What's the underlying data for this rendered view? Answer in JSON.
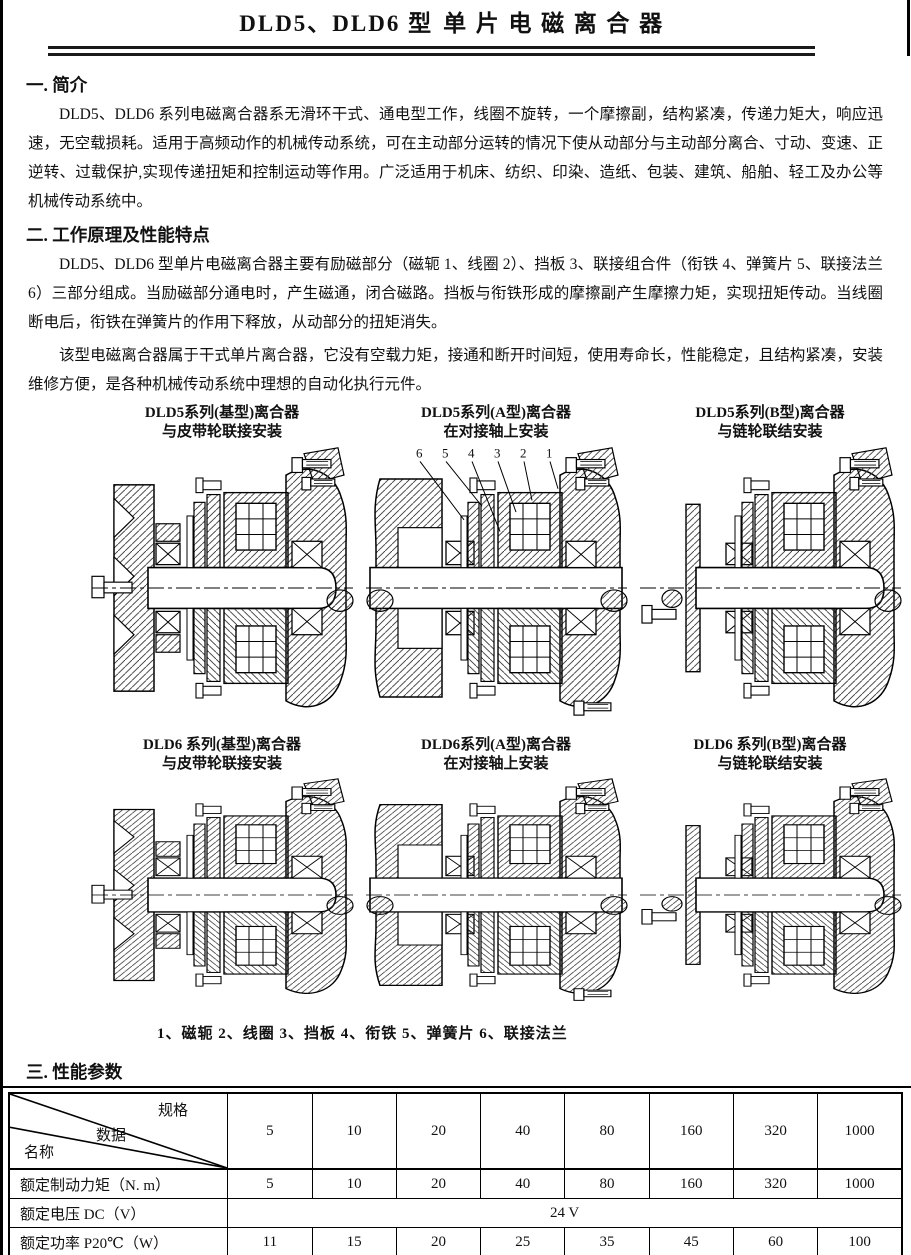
{
  "page": {
    "title_model": "DLD5、DLD6 型",
    "title_name": "单片电磁离合器"
  },
  "sections": {
    "s1": {
      "heading": "一. 简介",
      "p1": "DLD5、DLD6 系列电磁离合器系无滑环干式、通电型工作，线圈不旋转，一个摩擦副，结构紧凑，传递力矩大，响应迅速，无空载损耗。适用于高频动作的机械传动系统，可在主动部分运转的情况下使从动部分与主动部分离合、寸动、变速、正逆转、过载保护,实现传递扭矩和控制运动等作用。广泛适用于机床、纺织、印染、造纸、包装、建筑、船舶、轻工及办公等机械传动系统中。"
    },
    "s2": {
      "heading": "二. 工作原理及性能特点",
      "p1": "DLD5、DLD6 型单片电磁离合器主要有励磁部分（磁轭 1、线圈 2）、挡板 3、联接组合件（衔铁 4、弹簧片 5、联接法兰 6）三部分组成。当励磁部分通电时，产生磁通，闭合磁路。挡板与衔铁形成的摩擦副产生摩擦力矩，实现扭矩传动。当线圈断电后，衔铁在弹簧片的作用下释放，从动部分的扭矩消失。",
      "p2": "该型电磁离合器属于干式单片离合器，它没有空载力矩，接通和断开时间短，使用寿命长，性能稳定，且结构紧凑，安装维修方便，是各种机械传动系统中理想的自动化执行元件。"
    },
    "s3": {
      "heading": "三. 性能参数"
    },
    "s4": {
      "heading": "四. 外形及安装尺"
    }
  },
  "figures": {
    "captions": [
      {
        "line1": "DLD5系列(基型)离合器",
        "line2": "与皮带轮联接安装"
      },
      {
        "line1": "DLD5系列(A型)离合器",
        "line2": "在对接轴上安装"
      },
      {
        "line1": "DLD5系列(B型)离合器",
        "line2": "与链轮联结安装"
      },
      {
        "line1": "DLD6 系列(基型)离合器",
        "line2": "与皮带轮联接安装"
      },
      {
        "line1": "DLD6系列(A型)离合器",
        "line2": "在对接轴上安装"
      },
      {
        "line1": "DLD6 系列(B型)离合器",
        "line2": "与链轮联结安装"
      }
    ],
    "callouts": [
      "6",
      "5",
      "4",
      "3",
      "2",
      "1"
    ],
    "legend": "1、磁轭  2、线圈  3、挡板  4、衔铁  5、弹簧片  6、联接法兰"
  },
  "table": {
    "corner": {
      "top": "规格",
      "middle": "数据",
      "bottom": "名称"
    },
    "spec_columns": [
      "5",
      "10",
      "20",
      "40",
      "80",
      "160",
      "320",
      "1000"
    ],
    "rows": [
      {
        "label": "额定制动力矩（N. m）",
        "cells": [
          "5",
          "10",
          "20",
          "40",
          "80",
          "160",
          "320",
          "1000"
        ]
      },
      {
        "label": "额定电压 DC（V）",
        "merged": "24 V"
      },
      {
        "label": "额定功率 P20℃（W）",
        "cells": [
          "11",
          "15",
          "20",
          "25",
          "35",
          "45",
          "60",
          "100"
        ]
      },
      {
        "label": "最高转速（rpm）",
        "cells": [
          "6000",
          "5000",
          "4000",
          "3500",
          "3000",
          "2000",
          "1500"
        ]
      }
    ]
  }
}
